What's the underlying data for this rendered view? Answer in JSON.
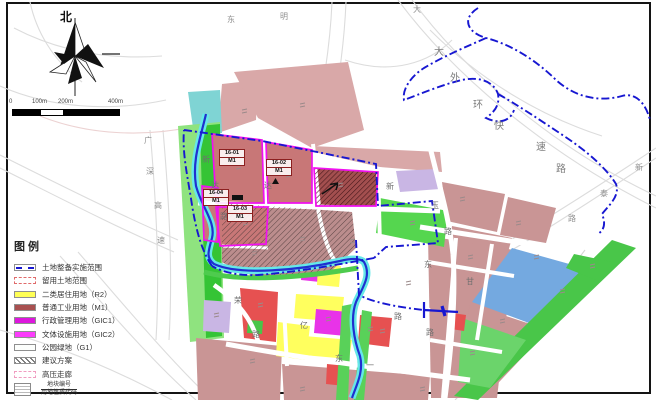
{
  "compass": {
    "north_label": "北"
  },
  "scale_bar": {
    "labels": [
      "0",
      "100m",
      "200m",
      "400m"
    ]
  },
  "legend": {
    "title": "图例",
    "items": [
      {
        "label": "土地整备实施范围"
      },
      {
        "label": "留用土地范围"
      },
      {
        "label": "二类居住用地（R2）"
      },
      {
        "label": "普通工业用地（M1）"
      },
      {
        "label": "行政管理用地（GIC1）"
      },
      {
        "label": "文体设施用地（GIC2）"
      },
      {
        "label": "公园绿地（G1）"
      },
      {
        "label": "建议方案"
      },
      {
        "label": "高压走廊"
      }
    ],
    "note": {
      "top": "地块编号",
      "bottom": "用地性质代码"
    }
  },
  "map": {
    "plots": [
      {
        "code": "16-01",
        "use": "M1"
      },
      {
        "code": "16-02",
        "use": "M1"
      },
      {
        "code": "16-03",
        "use": "M1"
      },
      {
        "code": "16-04",
        "use": "M1"
      }
    ],
    "road_labels": [
      "东",
      "明",
      "大",
      "大",
      "外",
      "环",
      "快",
      "速",
      "路",
      "新",
      "泰",
      "路",
      "广",
      "深",
      "高",
      "速",
      "新",
      "达",
      "路",
      "达",
      "新",
      "玉",
      "路",
      "荣",
      "路",
      "亿",
      "东",
      "一",
      "东",
      "甘",
      "路",
      "路"
    ]
  },
  "colors": {
    "boundary_blue": "#1717d1",
    "river_blue": "#2030cf",
    "river_cyan": "#66e8e8",
    "water_fill": "#74a9e0",
    "park_green": "#3ec43e",
    "residential_yellow": "#ffff55",
    "industrial_red": "#a85050",
    "admin_magenta": "#dd17dd",
    "culture_magenta": "#fb3cfb",
    "reserved_pink": "#e06a6a",
    "hv_pink": "#f09cc0",
    "plot_dusty_pink": "#c99595",
    "red_plot": "#e65151",
    "lavender_plot": "#c9b6e4"
  }
}
